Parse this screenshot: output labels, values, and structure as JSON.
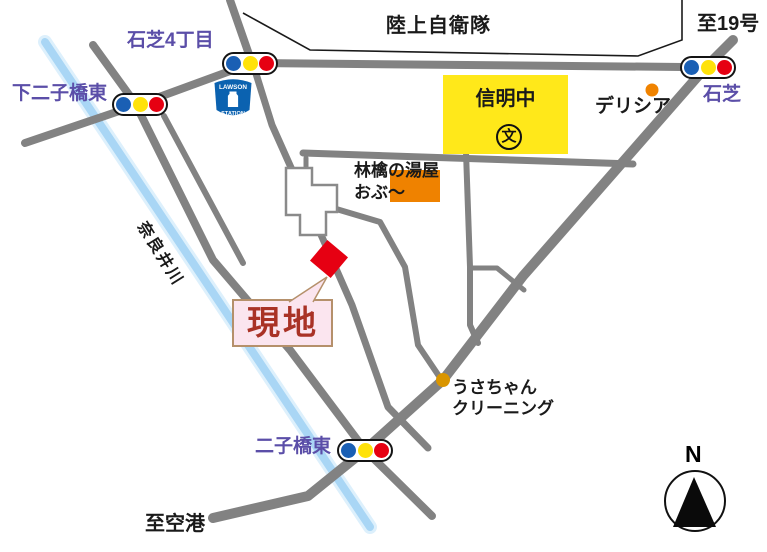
{
  "map_title": "access-map",
  "labels": {
    "jieitai": "陸上自衛隊",
    "to_route19": "至19号",
    "ishishiba4": "石芝4丁目",
    "shimofutagobashi": "下二子橋東",
    "ishishiba": "石芝",
    "shinmei": "信明中",
    "school_symbol": "文",
    "delicia": "デリシア",
    "ringo_line1": "林檎の湯屋",
    "ringo_line2": "おぶ〜",
    "naraigawa": "奈良井川",
    "genchi": "現地",
    "usachan_line1": "うさちゃん",
    "usachan_line2": "クリーニング",
    "futagobashi": "二子橋東",
    "to_airport": "至空港",
    "compass_n": "N",
    "lawson_top": "LAWSON",
    "lawson_bottom": "STATION"
  },
  "colors": {
    "road": "#828282",
    "river": "#A9D6F5",
    "river_halo": "#DDF0FC",
    "boundary": "#1a1a1a",
    "purple": "#5B4EA8",
    "school_fill": "#FFE81A",
    "bath_fill": "#EF8200",
    "marker_red": "#E60012",
    "genchi_bg": "#FBE5EF",
    "genchi_border": "#B5906B",
    "genchi_text": "#A93226",
    "signal_blue": "#1A5FB4",
    "signal_yellow": "#FFE20A",
    "signal_red": "#E60012",
    "lawson_blue": "#0B62B0",
    "dot_delicia": "#F08300",
    "dot_cleaning": "#D99500",
    "building_outline": "#8a8a8a"
  },
  "landmarks": [
    {
      "name": "ground-self-defense-force",
      "label_key": "jieitai"
    },
    {
      "name": "shinmei-junior-high",
      "label_key": "shinmei",
      "type": "school"
    },
    {
      "name": "delicia-store",
      "label_key": "delicia",
      "type": "dot"
    },
    {
      "name": "ringo-no-yuya-obu",
      "label_key": "ringo_line1",
      "type": "building"
    },
    {
      "name": "lawson-station",
      "type": "convenience-store"
    },
    {
      "name": "usachan-cleaning",
      "label_key": "usachan_line1",
      "type": "dot"
    },
    {
      "name": "site-genchi",
      "label_key": "genchi",
      "type": "red-marker"
    }
  ],
  "intersections": [
    "石芝4丁目",
    "下二子橋東",
    "石芝",
    "二子橋東"
  ],
  "destinations": [
    "至19号",
    "至空港"
  ],
  "river_name": "奈良井川"
}
